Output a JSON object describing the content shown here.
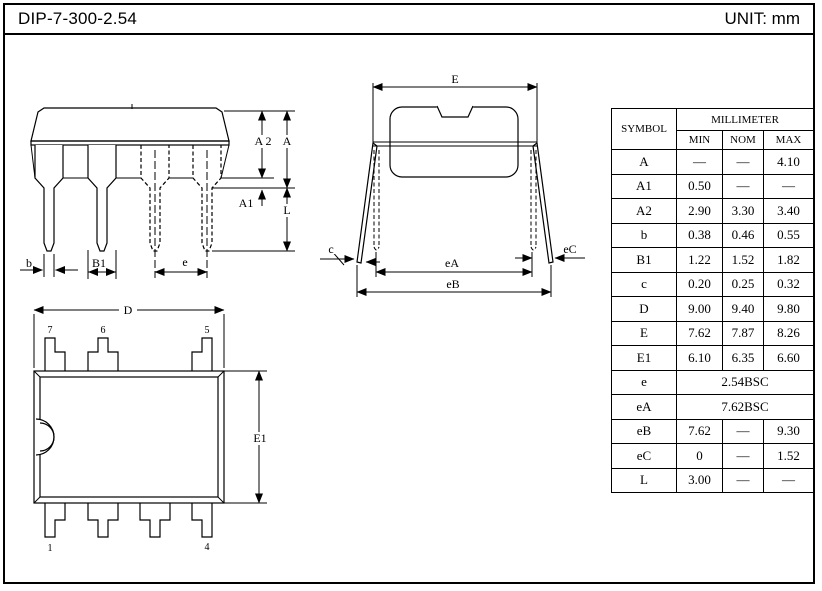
{
  "header": {
    "title": "DIP-7-300-2.54",
    "unit": "UNIT: mm"
  },
  "table": {
    "symbol_header": "SYMBOL",
    "unit_header": "MILLIMETER",
    "columns": [
      "MIN",
      "NOM",
      "MAX"
    ],
    "rows": [
      {
        "symbol": "A",
        "min": "—",
        "nom": "—",
        "max": "4.10"
      },
      {
        "symbol": "A1",
        "min": "0.50",
        "nom": "—",
        "max": "—"
      },
      {
        "symbol": "A2",
        "min": "2.90",
        "nom": "3.30",
        "max": "3.40"
      },
      {
        "symbol": "b",
        "min": "0.38",
        "nom": "0.46",
        "max": "0.55"
      },
      {
        "symbol": "B1",
        "min": "1.22",
        "nom": "1.52",
        "max": "1.82"
      },
      {
        "symbol": "c",
        "min": "0.20",
        "nom": "0.25",
        "max": "0.32"
      },
      {
        "symbol": "D",
        "min": "9.00",
        "nom": "9.40",
        "max": "9.80"
      },
      {
        "symbol": "E",
        "min": "7.62",
        "nom": "7.87",
        "max": "8.26"
      },
      {
        "symbol": "E1",
        "min": "6.10",
        "nom": "6.35",
        "max": "6.60"
      },
      {
        "symbol": "e",
        "span": "2.54BSC"
      },
      {
        "symbol": "eA",
        "span": "7.62BSC"
      },
      {
        "symbol": "eB",
        "min": "7.62",
        "nom": "—",
        "max": "9.30"
      },
      {
        "symbol": "eC",
        "min": "0",
        "nom": "—",
        "max": "1.52"
      },
      {
        "symbol": "L",
        "min": "3.00",
        "nom": "—",
        "max": "—"
      }
    ]
  },
  "front_view": {
    "labels": {
      "a2": "A 2",
      "a": "A",
      "a1": "A1",
      "l": "L",
      "b": "b",
      "b1": "B1",
      "e": "e"
    }
  },
  "side_view": {
    "labels": {
      "e": "E",
      "c": "c",
      "ea": "eA",
      "eb": "eB",
      "ec": "eC"
    }
  },
  "top_view": {
    "labels": {
      "d": "D",
      "e1": "E1",
      "pin7": "7",
      "pin6": "6",
      "pin5": "5",
      "pin1": "1",
      "pin4": "4"
    }
  },
  "colors": {
    "ink": "#000000",
    "paper": "#ffffff"
  }
}
